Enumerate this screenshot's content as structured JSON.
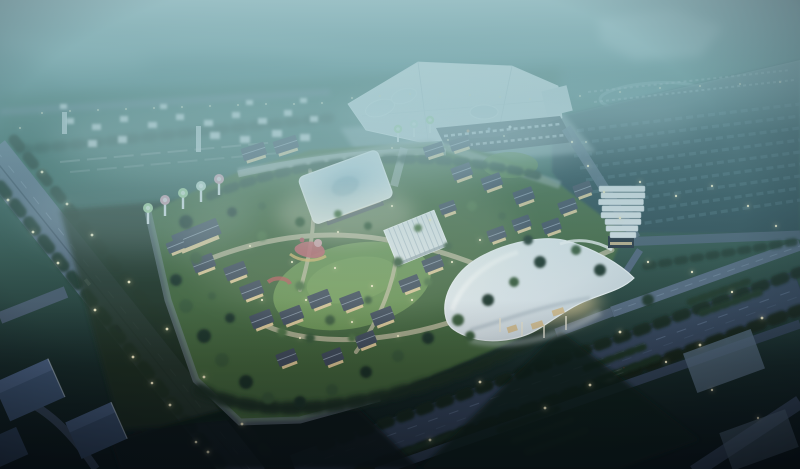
{
  "scene": {
    "type": "aerial architectural rendering",
    "time_of_day": "dusk",
    "subject": "night-lit masterplan: exhibition center, villa campus with glowing square pavilion, wavy gateway canopy, stepped tower, boulevards, parking fields"
  },
  "palette": {
    "haze_top": "#a9cfd4",
    "sky_teal": "#74aab4",
    "land_green": "#3e665c",
    "ground_dark": "#0a1413",
    "campus_green": "#4c7240",
    "lawn": "#6d9551",
    "tree_dark": "#1d3326",
    "tree_mid": "#3a5a38",
    "tree_light": "#4f7343",
    "road_light": "#5f7086",
    "road_mid": "#46566c",
    "road_dark": "#2e3c52",
    "path_tan": "#cfc5a8",
    "building_white": "#eef1f3",
    "roof_slate": "#434c5c",
    "wall_warm": "#e6cd9a",
    "light_warm": "#fff4cc",
    "pavilion_blue": "#a9c8da",
    "canopy_white": "#eef2f5",
    "sculpture_green": "#b5dfa6",
    "sculpture_pink": "#e4aebc",
    "building_blue": "#415877",
    "pad_blue": "#63798e"
  },
  "elements": [
    "exhibition-center",
    "glowing-square-pavilion",
    "lattice-pavilion",
    "wavy-gateway-canopy",
    "stepped-tower",
    "villa-houses",
    "central-lawn",
    "playground",
    "tulip-tree-sculptures",
    "left-boulevard",
    "bottom-highway",
    "right-roads",
    "rooftop-parking-field",
    "distant-neighborhood",
    "stadium-oval",
    "street-lights",
    "tree-rows",
    "blue-buildings-corner",
    "misty-wetlands"
  ]
}
